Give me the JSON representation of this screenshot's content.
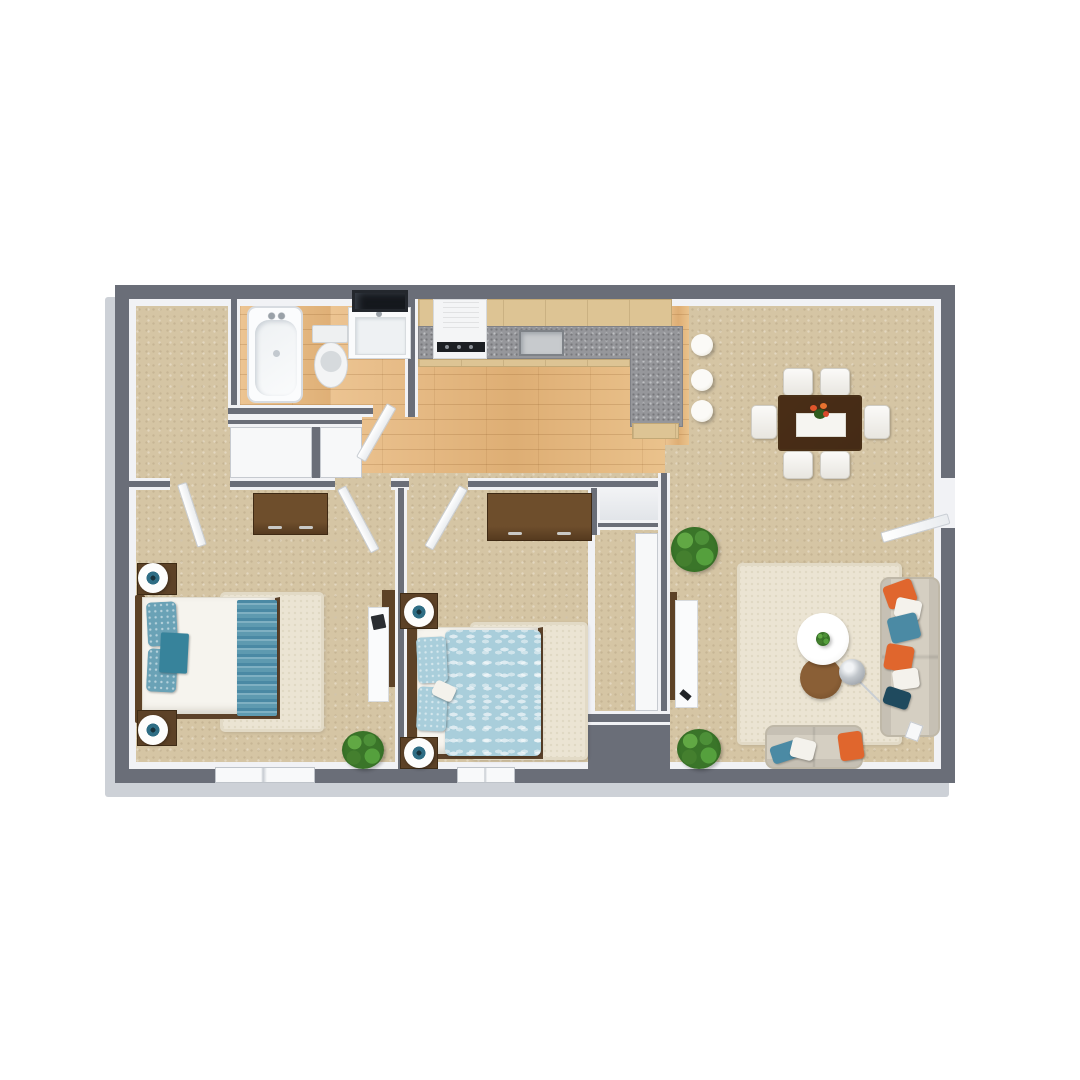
{
  "meta": {
    "kind": "3d-rendered-floor-plan",
    "view": "top-down isometric",
    "text_visible": false,
    "layout": "2 bedroom / 1 bathroom apartment"
  },
  "colors": {
    "wall": "#6a6e78",
    "wallface": "#f1f2f5",
    "base": "#cdd1d7",
    "carpet": "#d5c5a4",
    "wood": "#e5ba83",
    "granite": "#96979b",
    "cabinet": "#ddc494",
    "rug": "#ebe4d3",
    "furniture_brown": "#5d4227",
    "table_brown": "#6b4a2a",
    "bed_white": "#f6f4ee",
    "blue_runner": "#5e9ab0",
    "blue_pillow": "#6aa2b6",
    "duvet_blue": "#a9cedb",
    "teal_throw": "#37839b",
    "sofa": "#d5cfc2",
    "orange": "#e0662d",
    "navy": "#1f4a5e",
    "plant": "#3a7529",
    "fixture_white": "#f7f8f9",
    "stool": "#f3f1ea",
    "black": "#1c1f23",
    "lamp_teal": "#2e6d84"
  },
  "rooms": [
    {
      "name": "walk-in-closet",
      "floor": "carpet",
      "furniture": []
    },
    {
      "name": "bathroom",
      "floor": "wood",
      "furniture": [
        {
          "item": "bathtub",
          "count": 1
        },
        {
          "item": "toilet",
          "count": 1
        },
        {
          "item": "vanity-sink",
          "count": 1
        },
        {
          "item": "mirror",
          "count": 1
        }
      ]
    },
    {
      "name": "kitchen",
      "floor": "wood",
      "furniture": [
        {
          "item": "range-with-hood",
          "count": 1
        },
        {
          "item": "l-shaped-granite-counter",
          "count": 1
        },
        {
          "item": "kitchen-sink",
          "count": 1
        },
        {
          "item": "bar-stool",
          "count": 3
        }
      ]
    },
    {
      "name": "dining-area",
      "floor": "carpet",
      "furniture": [
        {
          "item": "dining-table",
          "count": 1
        },
        {
          "item": "dining-chair",
          "count": 6
        },
        {
          "item": "flower-centerpiece",
          "count": 1
        }
      ]
    },
    {
      "name": "living-room",
      "floor": "carpet",
      "furniture": [
        {
          "item": "sofa",
          "count": 1
        },
        {
          "item": "loveseat",
          "count": 1
        },
        {
          "item": "round-coffee-table",
          "count": 1
        },
        {
          "item": "round-side-table",
          "count": 1
        },
        {
          "item": "arc-floor-lamp",
          "count": 1
        },
        {
          "item": "area-rug",
          "count": 1
        },
        {
          "item": "tv-console",
          "count": 1
        },
        {
          "item": "potted-plant",
          "count": 2
        },
        {
          "item": "throw-pillow",
          "count": 9
        }
      ]
    },
    {
      "name": "bedroom-1",
      "floor": "carpet",
      "furniture": [
        {
          "item": "bed-white-blue-runner",
          "count": 1
        },
        {
          "item": "nightstand",
          "count": 2
        },
        {
          "item": "table-lamp",
          "count": 2
        },
        {
          "item": "dresser",
          "count": 1
        },
        {
          "item": "desk",
          "count": 1
        },
        {
          "item": "area-rug",
          "count": 1
        },
        {
          "item": "potted-plant",
          "count": 1
        },
        {
          "item": "window",
          "count": 1
        }
      ]
    },
    {
      "name": "bedroom-2",
      "floor": "carpet",
      "furniture": [
        {
          "item": "bed-blue-leaf-duvet",
          "count": 1
        },
        {
          "item": "nightstand",
          "count": 2
        },
        {
          "item": "table-lamp",
          "count": 2
        },
        {
          "item": "dresser",
          "count": 1
        },
        {
          "item": "sliding-closet",
          "count": 1
        },
        {
          "item": "area-rug",
          "count": 1
        },
        {
          "item": "window",
          "count": 1
        }
      ]
    },
    {
      "name": "hallway",
      "floor": "wood",
      "furniture": [
        {
          "item": "closet",
          "count": 2
        },
        {
          "item": "interior-door",
          "count": 4
        }
      ]
    }
  ],
  "openings": {
    "entry_door": "right wall of living room",
    "windows_bottom_wall": 2
  }
}
